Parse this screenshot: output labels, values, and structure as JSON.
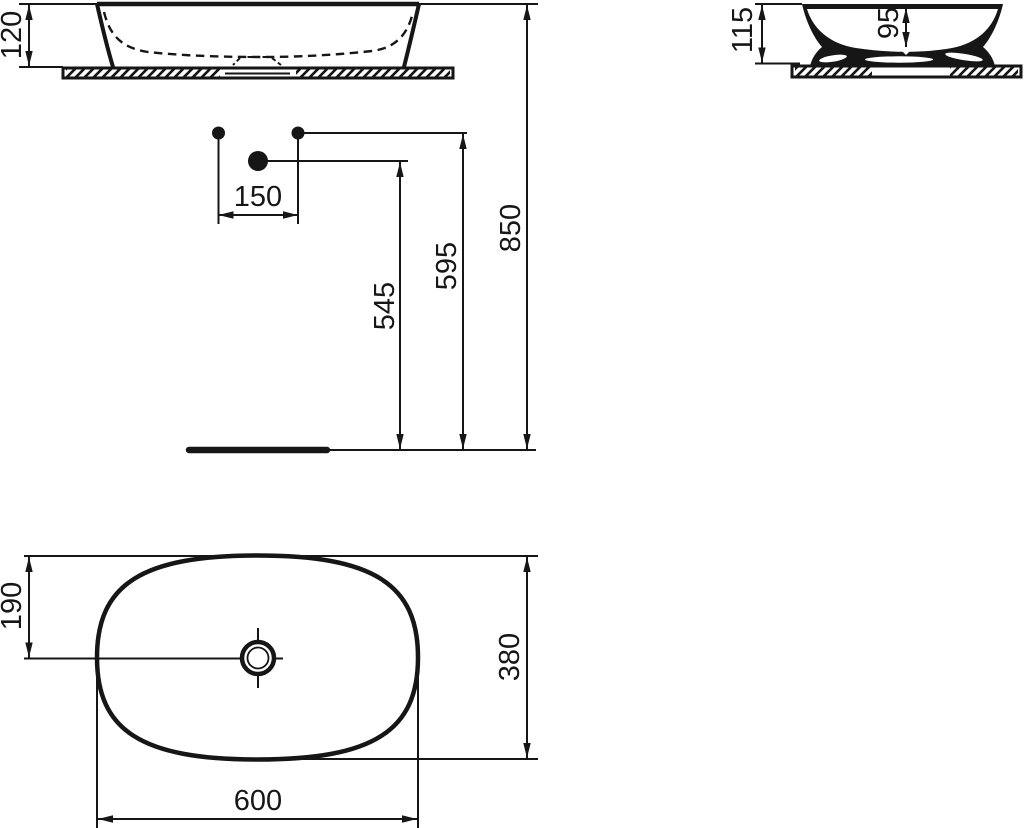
{
  "drawing": {
    "kind": "washbasin installation technical drawing",
    "line_color": "#161616",
    "background_color": "#ffffff"
  },
  "front_view": {
    "name": "front elevation",
    "dim_basin_height": "120"
  },
  "side_view": {
    "name": "side section",
    "dim_total_height": "115",
    "dim_bowl_depth": "95"
  },
  "installation_view": {
    "name": "wall fixture heights",
    "dim_hole_spacing": "150",
    "dim_height_low_point": "545",
    "dim_height_high_point": "595",
    "dim_height_rim": "850"
  },
  "plan_view": {
    "name": "plan view",
    "dim_drain_offset": "190",
    "dim_depth": "380",
    "dim_width": "600"
  }
}
